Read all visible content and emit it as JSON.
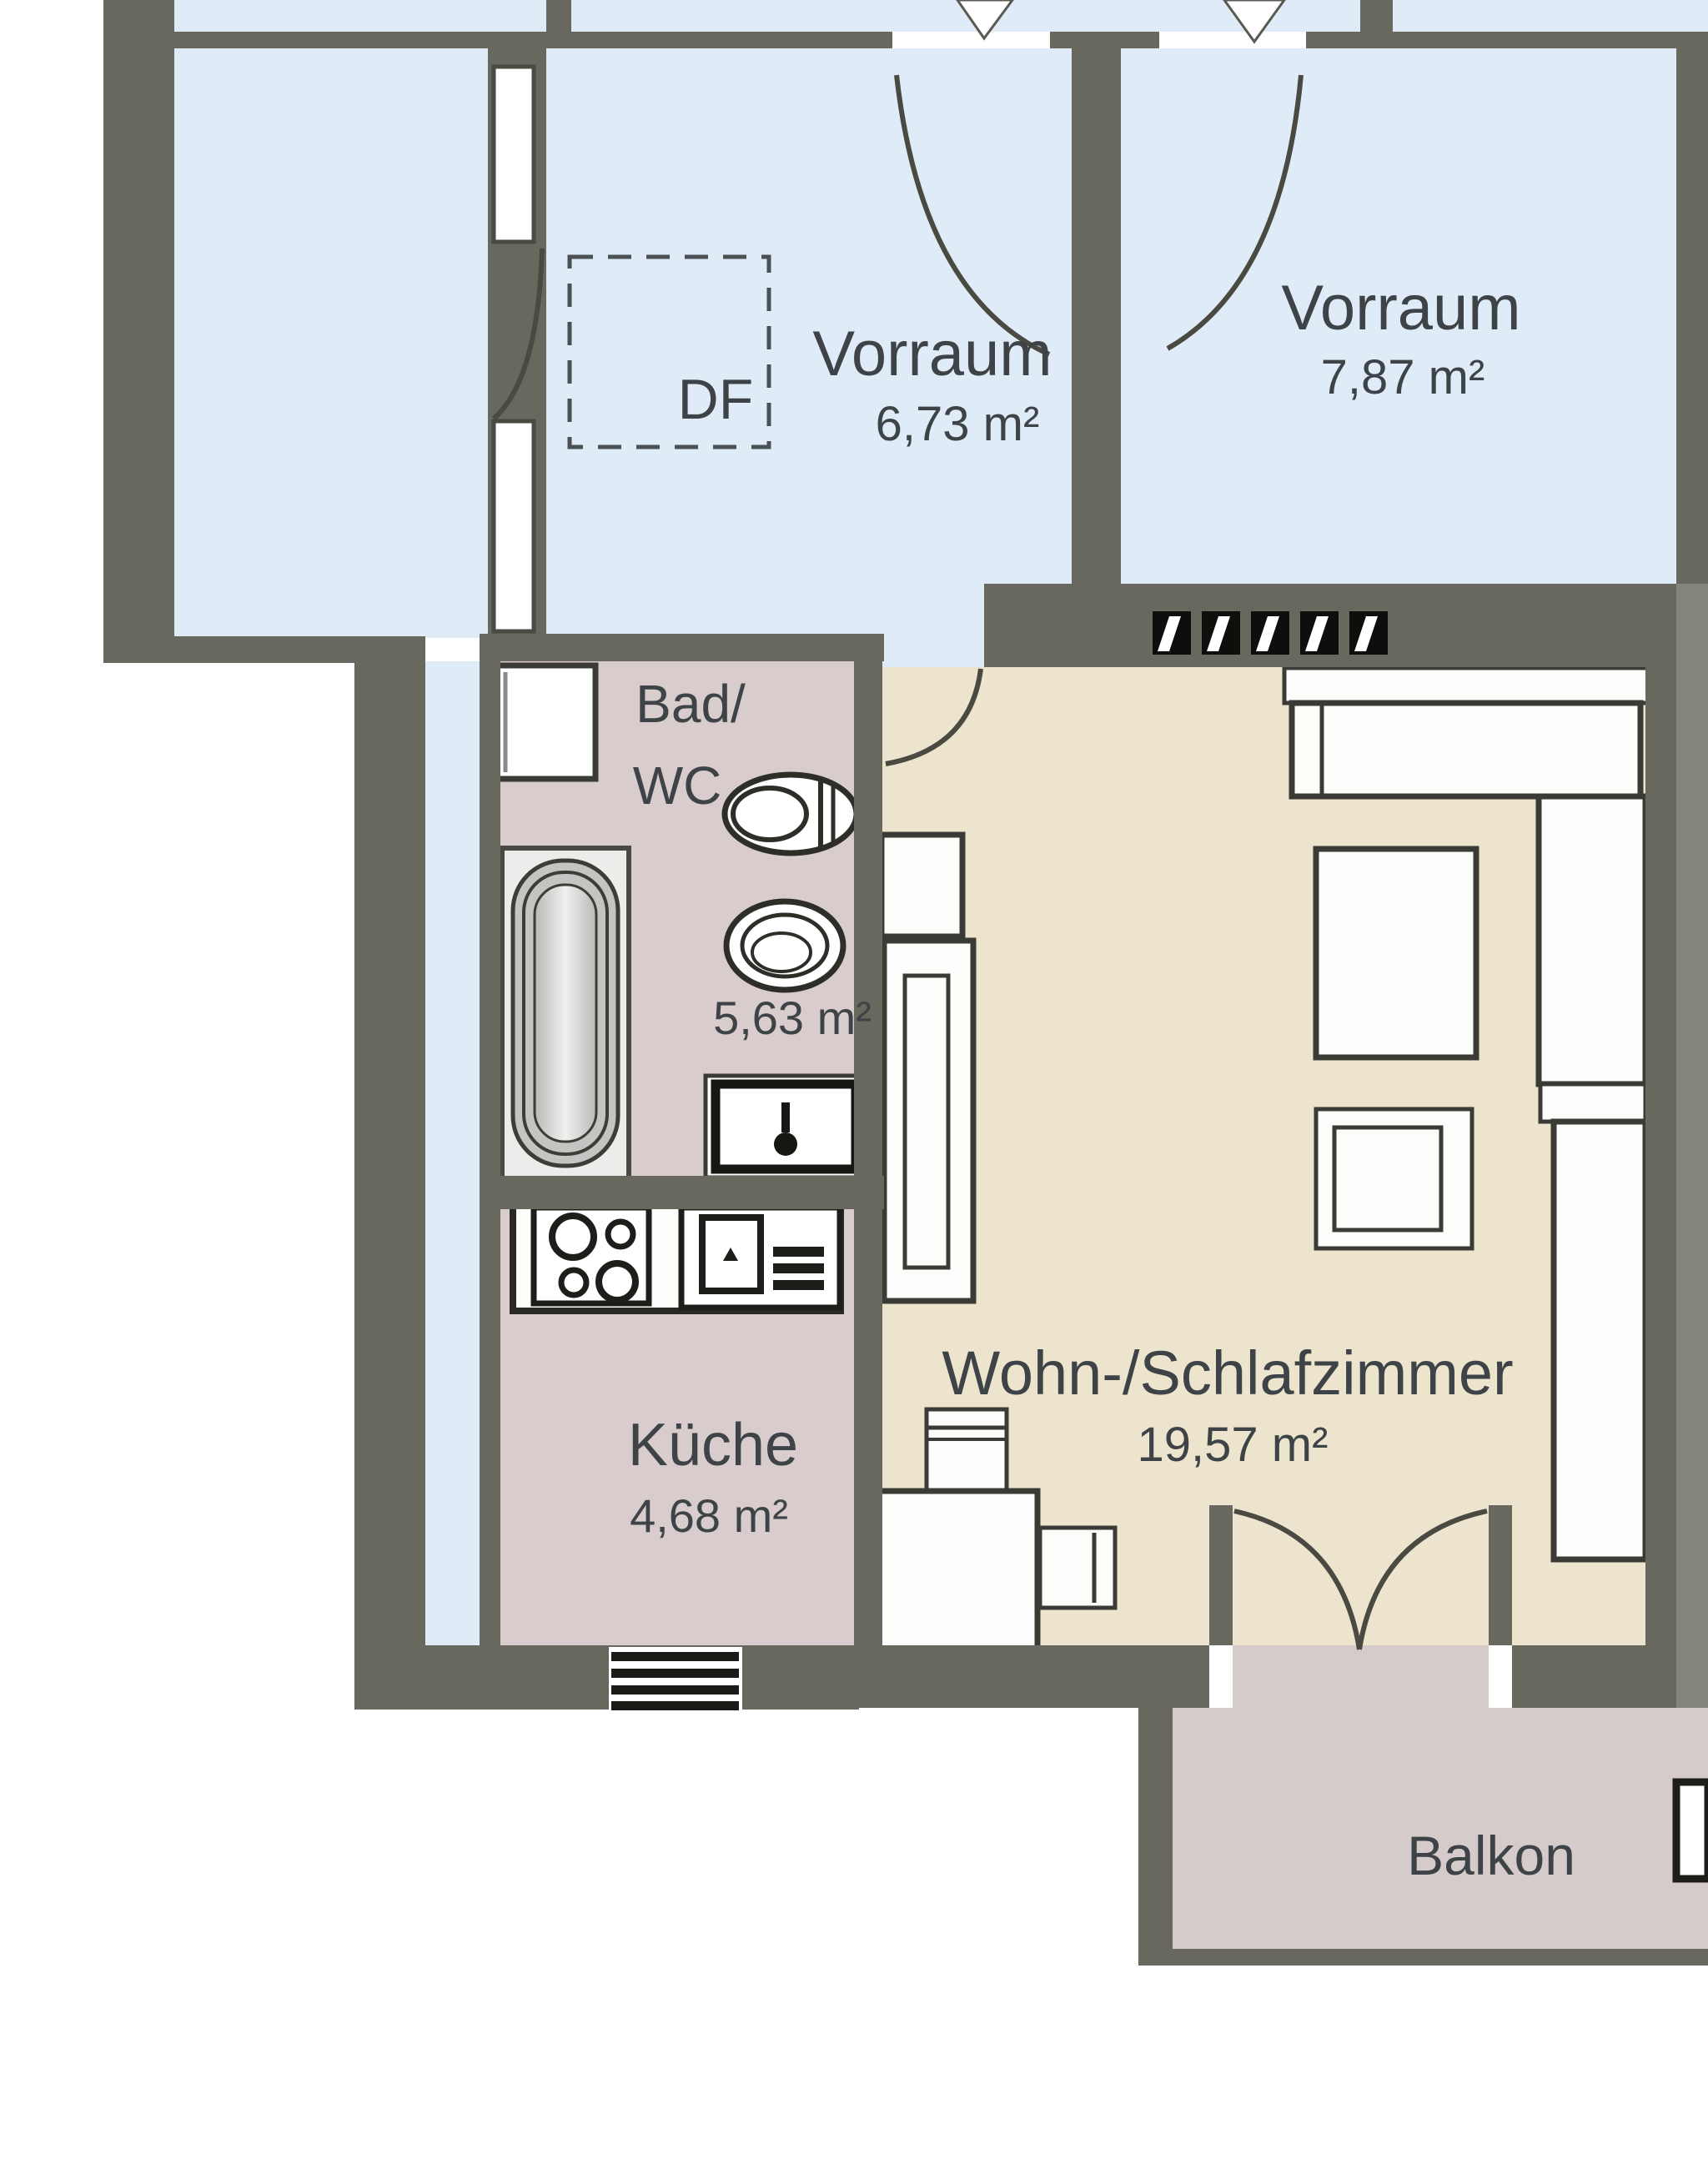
{
  "floor_plan": {
    "type": "apartment-floor-plan",
    "language": "de",
    "rooms": [
      {
        "id": "vorraum-left",
        "name": "Vorraum",
        "area": "6,73 m²"
      },
      {
        "id": "vorraum-right",
        "name": "Vorraum",
        "area": "7,87 m²"
      },
      {
        "id": "bad-wc",
        "name_line1": "Bad/",
        "name_line2": "WC",
        "area": "5,63 m²"
      },
      {
        "id": "kueche",
        "name": "Küche",
        "area": "4,68 m²"
      },
      {
        "id": "wohn-schlafzimmer",
        "name": "Wohn-/Schlafzimmer",
        "area": "19,57 m²"
      },
      {
        "id": "balkon",
        "name": "Balkon"
      }
    ],
    "annotations": {
      "roof_window_label": "DF"
    },
    "fixtures": [
      "bathtub",
      "toilet",
      "sink",
      "washing-machine",
      "stove",
      "kitchen-sink",
      "shaft"
    ],
    "furniture": [
      "sofa",
      "table",
      "armchair",
      "wardrobe",
      "shelf",
      "desk",
      "chairs"
    ],
    "colors": {
      "wall": "#68685f",
      "wall_light": "#85857c",
      "room_blue": "#dfecf7",
      "room_pink": "#d8cccd",
      "room_beige": "#ece4cc",
      "room_balcony": "#d6cbcb",
      "outline": "#3b3b35",
      "text": "#3e4347"
    }
  }
}
